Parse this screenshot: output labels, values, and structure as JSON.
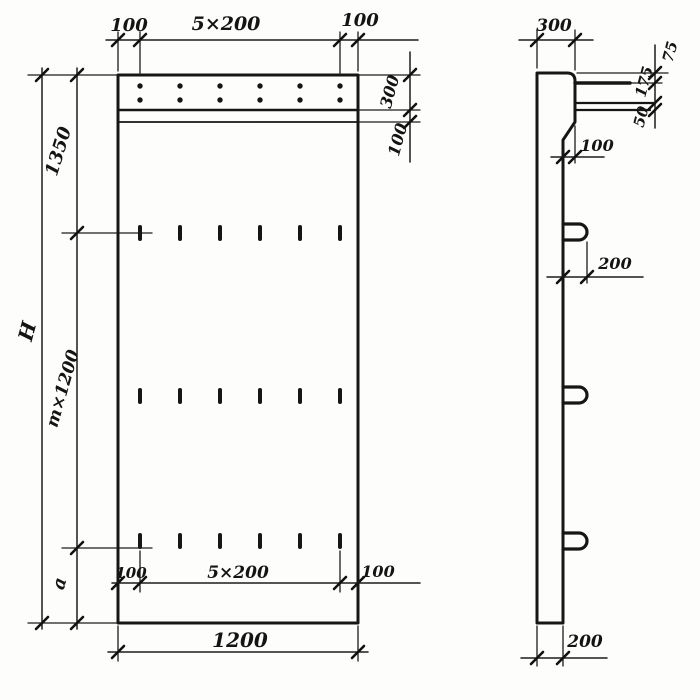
{
  "drawing": {
    "front_view": {
      "top_dims": {
        "left": "100",
        "center": "5×200",
        "right": "100"
      },
      "left_dims": {
        "overall": "H",
        "top": "1350",
        "middle": "m×1200",
        "bottom": "a"
      },
      "right_dims": {
        "band": "300",
        "groove": "100"
      },
      "inner_bottom_dims": {
        "left": "100",
        "center": "5×200",
        "right": "100"
      },
      "bottom_dim": "1200"
    },
    "side_view": {
      "top_dim": "300",
      "right_dims": {
        "top": "75",
        "middle": "175",
        "bottom": "50"
      },
      "step_dim": "100",
      "loop_dim": "200",
      "thickness_dim": "200"
    },
    "ink_color": "#161616",
    "paper_color": "#fdfdfb"
  }
}
